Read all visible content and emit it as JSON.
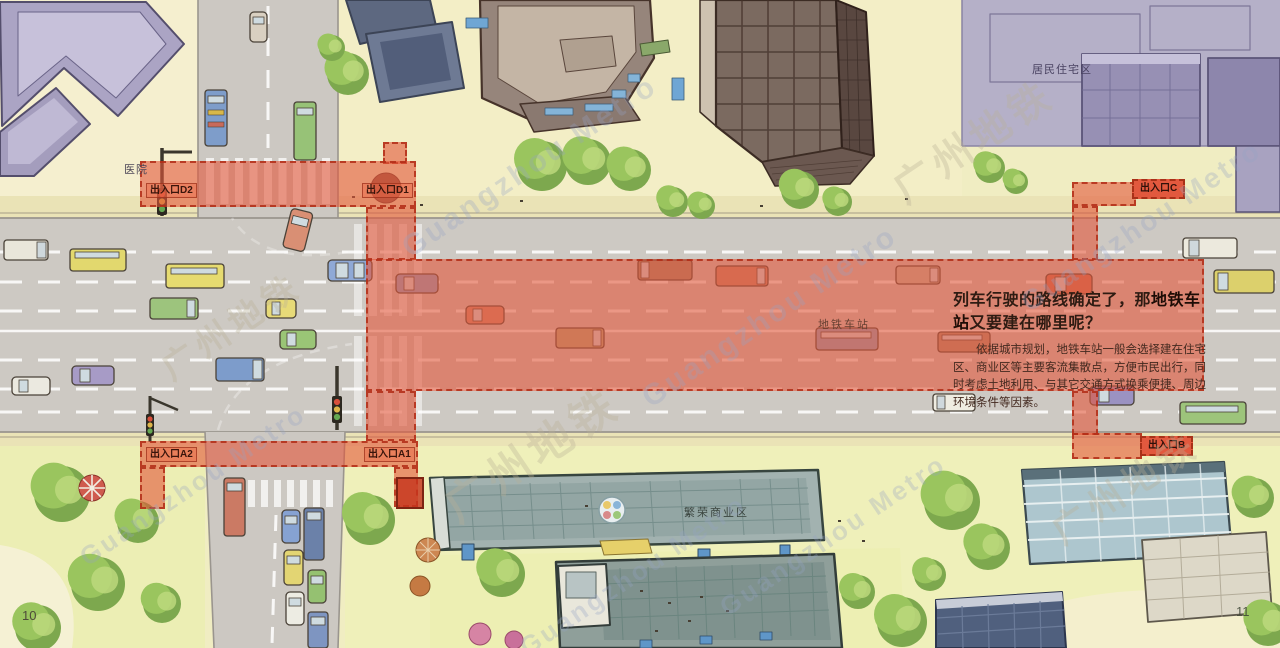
{
  "page": {
    "left_number": "10",
    "right_number": "11"
  },
  "watermark": {
    "cn": "广州地铁",
    "en": "Guangzhou Metro"
  },
  "labels": {
    "hospital": "医院",
    "residential": "居民住宅区",
    "commercial": "繁荣商业区",
    "station": "地铁车站"
  },
  "exits": {
    "d2": "出入口D2",
    "d1": "出入口D1",
    "c": "出入口C",
    "a2": "出入口A2",
    "a1": "出入口A1",
    "b": "出入口B"
  },
  "callout": {
    "title_prefix": "列车行驶的路线确定了，那",
    "title_highlight": "地铁车站",
    "title_suffix": "又要建在哪里呢？",
    "body": "依据城市规划，地铁车站一般会选择建在住宅区、商业区等主要客流集散点，方便市民出行，同时考虑土地利用、与其它交通方式换乘便捷、周边环境条件等因素。"
  },
  "colors": {
    "overlay_red": "#e3563a",
    "overlay_border": "#b22c16",
    "road_gray": "#cdc9c3",
    "land_yellow": "#f0edc2",
    "residential_purple": "#b5b0c8"
  }
}
